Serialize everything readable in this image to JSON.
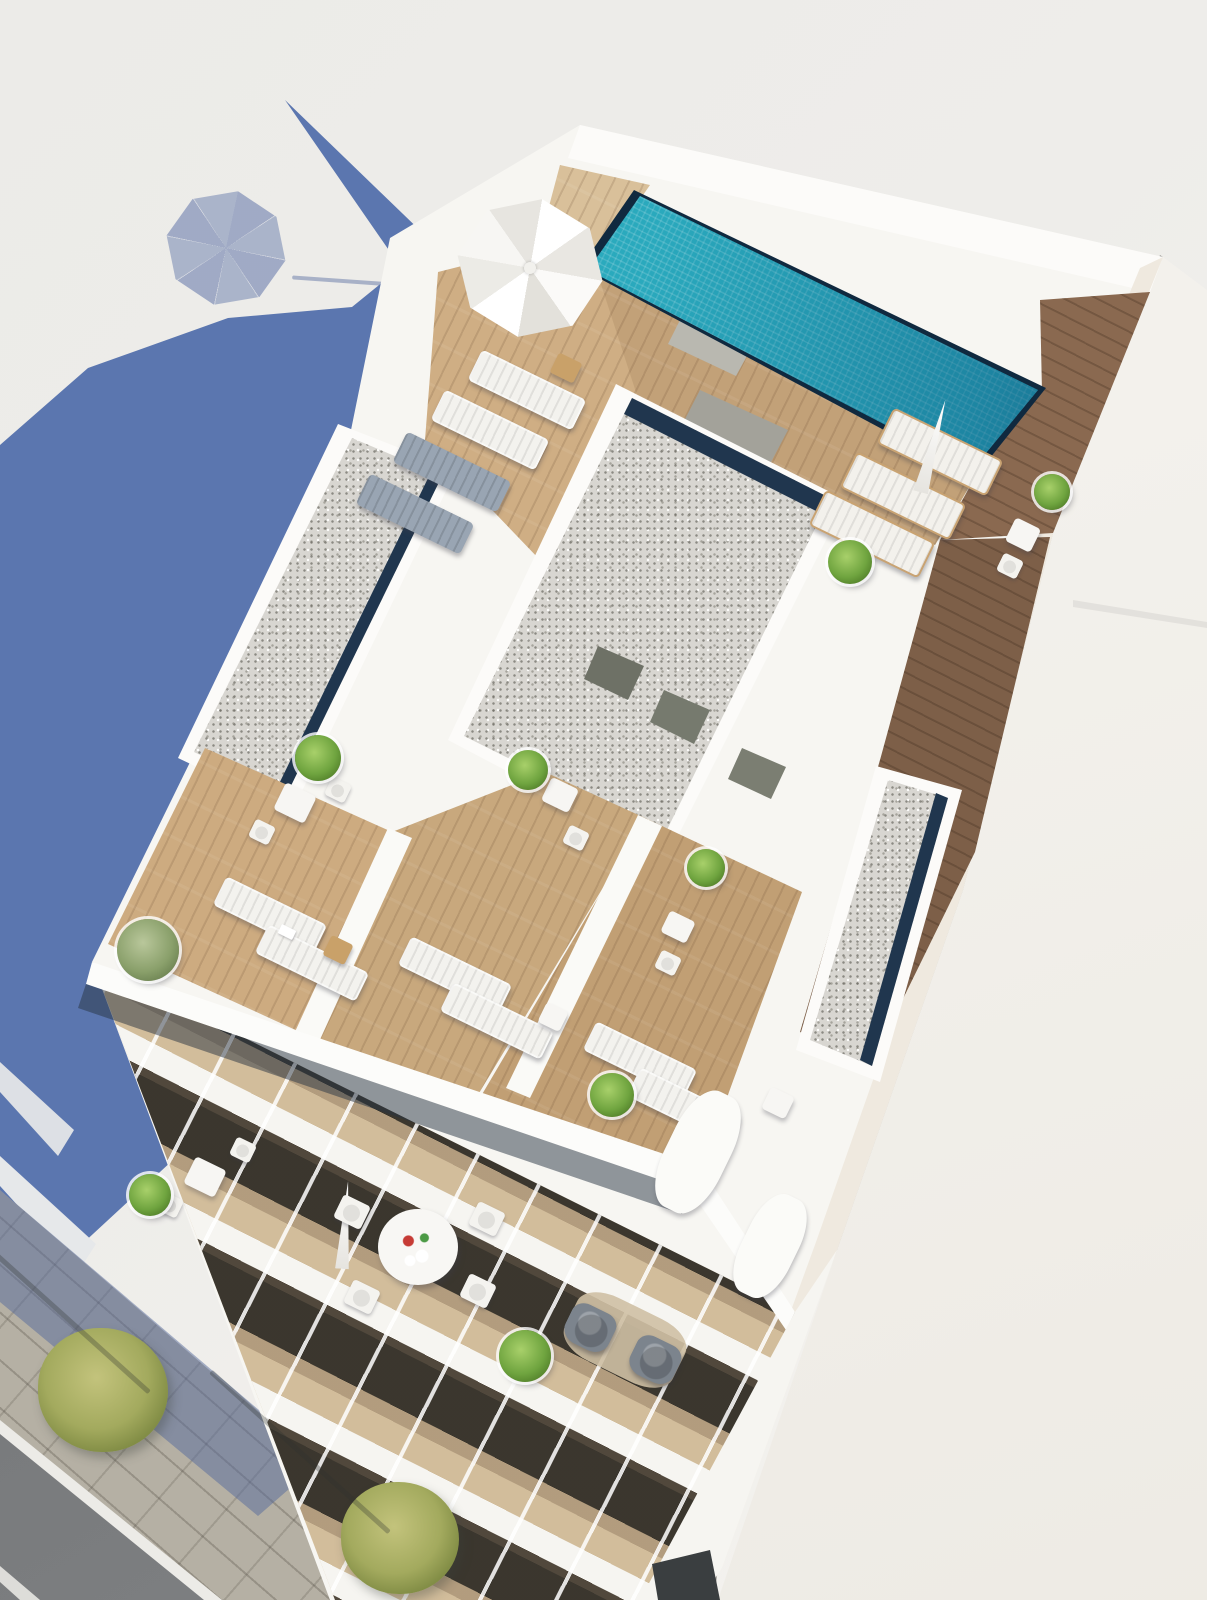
{
  "meta": {
    "kind": "3d-architectural-render",
    "description": "Aerial bird's-eye 3D rendering of a modern white apartment building: rooftop with turquoise swimming pool, wooden sun decks, gravel flat roofs, terraces with loungers and plants, stepped balconies below, and a street with trees at lower left. Long blue building shadow cast to the left.",
    "width": 1207,
    "height": 1600,
    "visible_text": []
  },
  "colors": {
    "background": "#edece9",
    "background_warm": "#f5f3ef",
    "shadow_blue": "#5b76af",
    "street_shadow": "rgba(86,106,156,0.5)",
    "building_white": "#f7f6f2",
    "parapet_white": "#fcfbf9",
    "wall_warm": "#efe9df",
    "neighbor_face": "#f3f1ec",
    "wood_light": "#d9c09a",
    "wood_mid": "#c2a178",
    "wood_dark": "#8a6950",
    "wood_deck_dark": "#7d5f48",
    "wood_pale": "#cfae84",
    "terrace_wood_left": "#cdab80",
    "terrace_wood_mid": "#c8a87d",
    "terrace_wood_right": "#c19f74",
    "facade_wood": "#d2bd9b",
    "gravel": "#d8d6d1",
    "groove_navy": "#20364e",
    "pool_edge_navy": "#10293f",
    "pool_water": "#2aa9bd",
    "road_asphalt": "#76787a",
    "sidewalk_paving": "#b5b0a4",
    "curb_white": "#ecebe7",
    "glass_dark": "#3a3e40",
    "lounger_white": "#f3f2ee",
    "lounger_gray": "#99a5b3",
    "armchair_gray": "#7c848d",
    "plant_green": "#6fa43f",
    "tree_yellow_green": "#a3aa5e"
  },
  "scene": {
    "items": [
      {
        "type": "umbrella-open",
        "name": "open-parasol",
        "x": 530,
        "y": 268,
        "w": 160,
        "h": 152,
        "rot": 10
      },
      {
        "type": "side-table",
        "name": "wood-side-table",
        "x": 566,
        "y": 368,
        "w": 26,
        "h": 22,
        "rot": 26
      },
      {
        "type": "lounger",
        "name": "sun-lounger",
        "x": 527,
        "y": 390,
        "w": 116,
        "h": 34,
        "rot": 26
      },
      {
        "type": "lounger",
        "name": "sun-lounger",
        "x": 490,
        "y": 430,
        "w": 116,
        "h": 34,
        "rot": 26
      },
      {
        "type": "lounger-gray",
        "name": "sun-lounger",
        "x": 452,
        "y": 472,
        "w": 116,
        "h": 34,
        "rot": 26
      },
      {
        "type": "lounger-gray",
        "name": "sun-lounger",
        "x": 415,
        "y": 514,
        "w": 116,
        "h": 34,
        "rot": 26
      },
      {
        "type": "lounger-wood",
        "name": "sun-lounger",
        "x": 940,
        "y": 452,
        "w": 118,
        "h": 36,
        "rot": 26
      },
      {
        "type": "lounger-wood",
        "name": "sun-lounger",
        "x": 903,
        "y": 496,
        "w": 118,
        "h": 36,
        "rot": 26
      },
      {
        "type": "lounger-wood",
        "name": "sun-lounger",
        "x": 872,
        "y": 534,
        "w": 118,
        "h": 36,
        "rot": 26
      },
      {
        "type": "umbrella-closed",
        "name": "closed-parasol",
        "x": 933,
        "y": 446,
        "w": 20,
        "h": 96,
        "rot": 15
      },
      {
        "type": "plant",
        "name": "potted-plant",
        "x": 850,
        "y": 562,
        "w": 44,
        "h": 44,
        "rot": 0
      },
      {
        "type": "table",
        "name": "bistro-table",
        "x": 1023,
        "y": 535,
        "w": 28,
        "h": 26,
        "rot": 26
      },
      {
        "type": "chair",
        "name": "bistro-chair",
        "x": 1010,
        "y": 566,
        "w": 22,
        "h": 20,
        "rot": 26
      },
      {
        "type": "plant",
        "name": "potted-plant",
        "x": 1052,
        "y": 492,
        "w": 36,
        "h": 36,
        "rot": 0
      },
      {
        "type": "table",
        "name": "bistro-table",
        "x": 295,
        "y": 803,
        "w": 34,
        "h": 30,
        "rot": 26
      },
      {
        "type": "chair",
        "name": "bistro-chair",
        "x": 262,
        "y": 832,
        "w": 22,
        "h": 20,
        "rot": 26
      },
      {
        "type": "chair",
        "name": "bistro-chair",
        "x": 338,
        "y": 790,
        "w": 22,
        "h": 20,
        "rot": 26
      },
      {
        "type": "plant",
        "name": "potted-plant",
        "x": 318,
        "y": 758,
        "w": 46,
        "h": 46,
        "rot": 0
      },
      {
        "type": "table",
        "name": "bistro-table",
        "x": 560,
        "y": 795,
        "w": 30,
        "h": 26,
        "rot": 26
      },
      {
        "type": "chair",
        "name": "bistro-chair",
        "x": 576,
        "y": 838,
        "w": 22,
        "h": 20,
        "rot": 26
      },
      {
        "type": "plant",
        "name": "potted-plant",
        "x": 528,
        "y": 770,
        "w": 40,
        "h": 40,
        "rot": 0
      },
      {
        "type": "plant-olive",
        "name": "olive-shrub",
        "x": 148,
        "y": 950,
        "w": 62,
        "h": 62,
        "rot": 0
      },
      {
        "type": "lounger",
        "name": "sun-lounger",
        "x": 270,
        "y": 915,
        "w": 112,
        "h": 32,
        "rot": 26
      },
      {
        "type": "lounger",
        "name": "sun-lounger",
        "x": 312,
        "y": 963,
        "w": 112,
        "h": 32,
        "rot": 26
      },
      {
        "type": "dot-book",
        "name": "book-on-lounger",
        "x": 287,
        "y": 932,
        "w": 16,
        "h": 10,
        "rot": 26
      },
      {
        "type": "side-table",
        "name": "deck-side-table",
        "x": 338,
        "y": 950,
        "w": 24,
        "h": 22,
        "rot": 26
      },
      {
        "type": "lounger",
        "name": "sun-lounger",
        "x": 455,
        "y": 975,
        "w": 112,
        "h": 32,
        "rot": 26
      },
      {
        "type": "lounger",
        "name": "sun-lounger",
        "x": 497,
        "y": 1021,
        "w": 112,
        "h": 32,
        "rot": 26
      },
      {
        "type": "table",
        "name": "deck-side-table",
        "x": 553,
        "y": 1017,
        "w": 24,
        "h": 22,
        "rot": 26
      },
      {
        "type": "lounger",
        "name": "sun-lounger",
        "x": 640,
        "y": 1060,
        "w": 112,
        "h": 32,
        "rot": 26
      },
      {
        "type": "lounger",
        "name": "sun-lounger",
        "x": 684,
        "y": 1106,
        "w": 112,
        "h": 32,
        "rot": 26
      },
      {
        "type": "table",
        "name": "deck-side-table",
        "x": 778,
        "y": 1103,
        "w": 26,
        "h": 24,
        "rot": 26
      },
      {
        "type": "table",
        "name": "bistro-table",
        "x": 678,
        "y": 927,
        "w": 28,
        "h": 24,
        "rot": 26
      },
      {
        "type": "chair",
        "name": "bistro-chair",
        "x": 668,
        "y": 963,
        "w": 22,
        "h": 20,
        "rot": 26
      },
      {
        "type": "plant",
        "name": "potted-plant",
        "x": 706,
        "y": 868,
        "w": 38,
        "h": 38,
        "rot": 0
      },
      {
        "type": "plant",
        "name": "potted-plant",
        "x": 612,
        "y": 1095,
        "w": 44,
        "h": 44,
        "rot": 0
      },
      {
        "type": "table",
        "name": "balcony-table",
        "x": 205,
        "y": 1177,
        "w": 34,
        "h": 30,
        "rot": 26
      },
      {
        "type": "chair",
        "name": "balcony-chair",
        "x": 170,
        "y": 1205,
        "w": 22,
        "h": 20,
        "rot": 26
      },
      {
        "type": "chair",
        "name": "balcony-chair",
        "x": 243,
        "y": 1150,
        "w": 22,
        "h": 20,
        "rot": 26
      },
      {
        "type": "plant",
        "name": "potted-plant",
        "x": 150,
        "y": 1195,
        "w": 42,
        "h": 42,
        "rot": 0
      },
      {
        "type": "umbrella-closed",
        "name": "closed-parasol",
        "x": 345,
        "y": 1225,
        "w": 18,
        "h": 88,
        "rot": 4
      },
      {
        "type": "round-table",
        "name": "round-dining-table",
        "x": 418,
        "y": 1247,
        "w": 80,
        "h": 76,
        "rot": 0
      },
      {
        "type": "chair",
        "name": "dining-chair",
        "x": 352,
        "y": 1212,
        "w": 30,
        "h": 26,
        "rot": 26
      },
      {
        "type": "chair",
        "name": "dining-chair",
        "x": 487,
        "y": 1219,
        "w": 30,
        "h": 26,
        "rot": 26
      },
      {
        "type": "chair",
        "name": "dining-chair",
        "x": 362,
        "y": 1297,
        "w": 30,
        "h": 26,
        "rot": 26
      },
      {
        "type": "chair",
        "name": "dining-chair",
        "x": 478,
        "y": 1291,
        "w": 30,
        "h": 26,
        "rot": 26
      },
      {
        "type": "divider",
        "name": "balcony-divider-wall",
        "x": 698,
        "y": 1152,
        "w": 62,
        "h": 128,
        "rot": 26
      },
      {
        "type": "divider",
        "name": "balcony-divider-wall",
        "x": 770,
        "y": 1246,
        "w": 54,
        "h": 108,
        "rot": 26
      },
      {
        "type": "rug",
        "name": "outdoor-rug",
        "x": 625,
        "y": 1340,
        "w": 120,
        "h": 70,
        "rot": 26
      },
      {
        "type": "armchair",
        "name": "gray-armchair",
        "x": 590,
        "y": 1328,
        "w": 48,
        "h": 42,
        "rot": 26
      },
      {
        "type": "armchair",
        "name": "gray-armchair",
        "x": 655,
        "y": 1360,
        "w": 48,
        "h": 42,
        "rot": 26
      },
      {
        "type": "plant",
        "name": "potted-plant",
        "x": 525,
        "y": 1356,
        "w": 52,
        "h": 52,
        "rot": 0
      },
      {
        "type": "tree",
        "name": "street-tree",
        "x": 103,
        "y": 1390,
        "w": 130,
        "h": 124,
        "rot": 0
      },
      {
        "type": "tree",
        "name": "street-tree",
        "x": 400,
        "y": 1538,
        "w": 118,
        "h": 112,
        "rot": 0
      },
      {
        "type": "shadow-streak",
        "name": "tree-shadow",
        "x": 60,
        "y": 1312,
        "w": 240,
        "h": 5,
        "rot": 42
      },
      {
        "type": "shadow-streak",
        "name": "tree-shadow",
        "x": 300,
        "y": 1452,
        "w": 240,
        "h": 5,
        "rot": 42
      }
    ]
  }
}
